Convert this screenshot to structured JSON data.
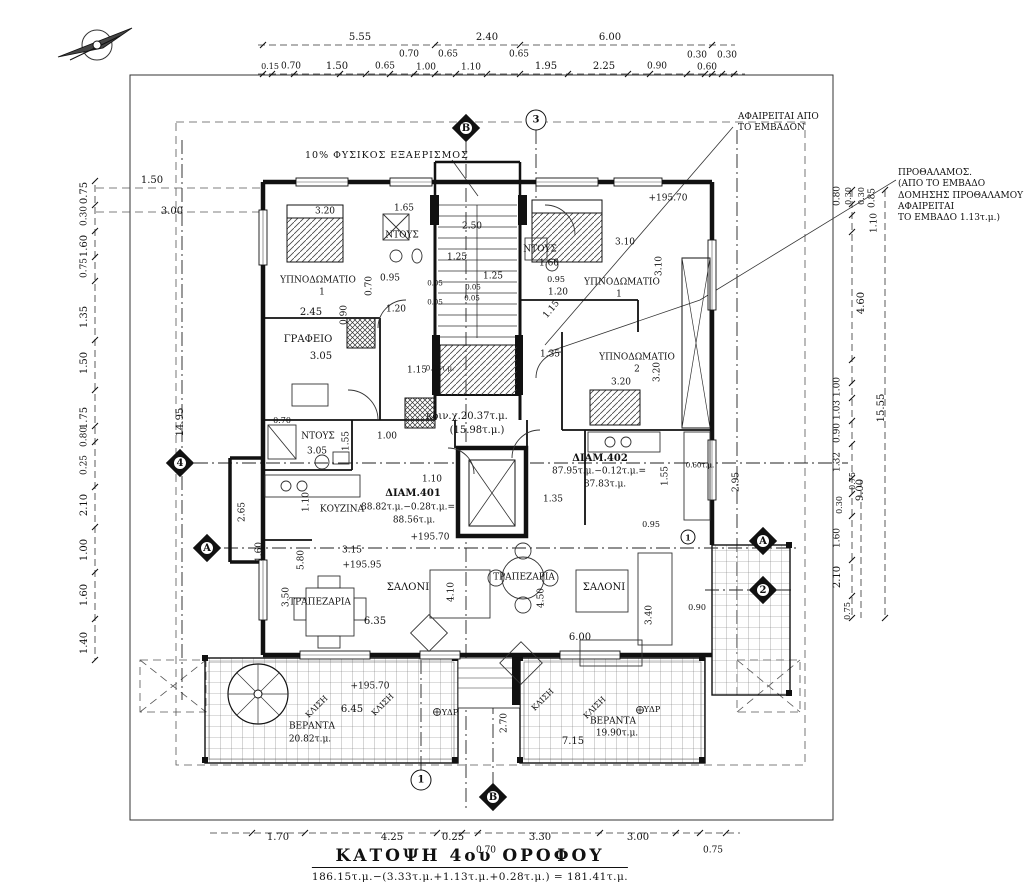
{
  "drawing": {
    "title": "ΚΑΤΟΨΗ 4ου ΟΡΟΦΟΥ",
    "area_formula": "186.15τ.μ.−(3.33τ.μ.+1.13τ.μ.+0.28τ.μ.) = 181.41τ.μ."
  },
  "notes": {
    "ventilation": "10% ΦΥΣΙΚΟΣ ΕΞΑΕΡΙΣΜΟΣ",
    "area_deduction": "ΑΦΑΙΡΕΙΤΑΙ ΑΠΟ\nΤΟ ΕΜΒΑΔΟΝ",
    "vestibule": "ΠΡΟΘΑΛΑΜΟΣ.\n(ΑΠΟ ΤΟ ΕΜΒΑΔΟ\nΔΟΜΗΣΗΣ ΠΡΟΘΑΛΑΜΟΥ\nΑΦΑΙΡΕΙΤΑΙ\nΤΟ ΕΜΒΑΔΟ 1.13τ.μ.)"
  },
  "colors": {
    "line": "#111111",
    "background": "#ffffff",
    "hatch": "#444444",
    "tile": "#777777"
  },
  "annotations": [
    {
      "t": "5.55",
      "x": 360,
      "y": 38
    },
    {
      "t": "2.40",
      "x": 487,
      "y": 38
    },
    {
      "t": "6.00",
      "x": 610,
      "y": 38
    },
    {
      "t": "0.15",
      "x": 270,
      "y": 67,
      "s": 8
    },
    {
      "t": "0.70",
      "x": 291,
      "y": 67,
      "s": 9
    },
    {
      "t": "1.50",
      "x": 337,
      "y": 67
    },
    {
      "t": "0.65",
      "x": 385,
      "y": 67,
      "s": 9
    },
    {
      "t": "0.70",
      "x": 409,
      "y": 55,
      "s": 9
    },
    {
      "t": "1.00",
      "x": 426,
      "y": 68,
      "s": 9
    },
    {
      "t": "0.65",
      "x": 448,
      "y": 55,
      "s": 9
    },
    {
      "t": "1.10",
      "x": 471,
      "y": 68,
      "s": 9
    },
    {
      "t": "0.65",
      "x": 519,
      "y": 55,
      "s": 9
    },
    {
      "t": "1.95",
      "x": 546,
      "y": 67
    },
    {
      "t": "2.25",
      "x": 604,
      "y": 67
    },
    {
      "t": "0.90",
      "x": 657,
      "y": 67,
      "s": 9
    },
    {
      "t": "0.30",
      "x": 697,
      "y": 56,
      "s": 9
    },
    {
      "t": "0.60",
      "x": 707,
      "y": 68,
      "s": 9
    },
    {
      "t": "0.30",
      "x": 727,
      "y": 56,
      "s": 9
    },
    {
      "t": "0.75",
      "x": 85,
      "y": 193,
      "r": -90
    },
    {
      "t": "0.30",
      "x": 85,
      "y": 216,
      "r": -90,
      "s": 9
    },
    {
      "t": "1.60",
      "x": 85,
      "y": 246,
      "r": -90
    },
    {
      "t": "0.75",
      "x": 85,
      "y": 268,
      "r": -90,
      "s": 9
    },
    {
      "t": "1.35",
      "x": 85,
      "y": 317,
      "r": -90
    },
    {
      "t": "1.50",
      "x": 85,
      "y": 363,
      "r": -90
    },
    {
      "t": "1.75",
      "x": 85,
      "y": 418,
      "r": -90
    },
    {
      "t": "0.80",
      "x": 85,
      "y": 437,
      "r": -90,
      "s": 9
    },
    {
      "t": "0.25",
      "x": 85,
      "y": 465,
      "r": -90,
      "s": 9
    },
    {
      "t": "2.10",
      "x": 85,
      "y": 505,
      "r": -90
    },
    {
      "t": "1.00",
      "x": 85,
      "y": 550,
      "r": -90
    },
    {
      "t": "1.60",
      "x": 85,
      "y": 595,
      "r": -90
    },
    {
      "t": "1.40",
      "x": 85,
      "y": 643,
      "r": -90
    },
    {
      "t": "14.95",
      "x": 181,
      "y": 422,
      "r": -90
    },
    {
      "t": "1.50",
      "x": 152,
      "y": 181
    },
    {
      "t": "3.00",
      "x": 172,
      "y": 212
    },
    {
      "t": "0.80",
      "x": 838,
      "y": 196,
      "r": -90,
      "s": 9
    },
    {
      "t": "0.30",
      "x": 849,
      "y": 196,
      "r": -90,
      "s": 8
    },
    {
      "t": "0.30",
      "x": 862,
      "y": 196,
      "r": -90,
      "s": 8
    },
    {
      "t": "0.85",
      "x": 873,
      "y": 198,
      "r": -90,
      "s": 9
    },
    {
      "t": "1.10",
      "x": 875,
      "y": 223,
      "r": -90,
      "s": 9
    },
    {
      "t": "4.60",
      "x": 862,
      "y": 303,
      "r": -90
    },
    {
      "t": "1.00",
      "x": 838,
      "y": 387,
      "r": -90,
      "s": 9
    },
    {
      "t": "1.03",
      "x": 838,
      "y": 410,
      "r": -90,
      "s": 9
    },
    {
      "t": "0.90",
      "x": 838,
      "y": 433,
      "r": -90,
      "s": 9
    },
    {
      "t": "1.32",
      "x": 838,
      "y": 462,
      "r": -90,
      "s": 9
    },
    {
      "t": "0.75",
      "x": 853,
      "y": 481,
      "r": -90,
      "s": 8
    },
    {
      "t": "9.00",
      "x": 861,
      "y": 490,
      "r": -90
    },
    {
      "t": "0.30",
      "x": 840,
      "y": 505,
      "r": -90,
      "s": 8
    },
    {
      "t": "1.60",
      "x": 838,
      "y": 538,
      "r": -90,
      "s": 9
    },
    {
      "t": "2.10",
      "x": 838,
      "y": 577,
      "r": -90
    },
    {
      "t": "0.75",
      "x": 848,
      "y": 611,
      "r": -90,
      "s": 8
    },
    {
      "t": "15.55",
      "x": 882,
      "y": 408,
      "r": -90
    },
    {
      "t": "1.70",
      "x": 278,
      "y": 838
    },
    {
      "t": "4.25",
      "x": 392,
      "y": 838
    },
    {
      "t": "0.25",
      "x": 453,
      "y": 838
    },
    {
      "t": "3.30",
      "x": 540,
      "y": 838
    },
    {
      "t": "3.00",
      "x": 638,
      "y": 838
    },
    {
      "t": "0.70",
      "x": 486,
      "y": 851,
      "s": 9
    },
    {
      "t": "0.75",
      "x": 713,
      "y": 851,
      "s": 9
    },
    {
      "t": "3.20",
      "x": 325,
      "y": 212,
      "s": 9
    },
    {
      "t": "1.65",
      "x": 404,
      "y": 209,
      "s": 9
    },
    {
      "t": "ΝΤΟΥΣ",
      "x": 402,
      "y": 236,
      "s": 9,
      "n": "room-label"
    },
    {
      "t": "2.50",
      "x": 472,
      "y": 227,
      "s": 9
    },
    {
      "t": "1.25",
      "x": 457,
      "y": 258,
      "s": 9
    },
    {
      "t": "1.25",
      "x": 493,
      "y": 277,
      "s": 9
    },
    {
      "t": "0.05",
      "x": 435,
      "y": 284,
      "s": 7
    },
    {
      "t": "0.05",
      "x": 473,
      "y": 288,
      "s": 7
    },
    {
      "t": "0.05",
      "x": 472,
      "y": 299,
      "s": 7
    },
    {
      "t": "0.05",
      "x": 435,
      "y": 303,
      "s": 7
    },
    {
      "t": "ΝΤΟΥΣ",
      "x": 540,
      "y": 250,
      "s": 9,
      "n": "room-label"
    },
    {
      "t": "1.60",
      "x": 549,
      "y": 264,
      "s": 9
    },
    {
      "t": "0.95",
      "x": 556,
      "y": 280,
      "s": 8
    },
    {
      "t": "1.20",
      "x": 558,
      "y": 293,
      "s": 9
    },
    {
      "t": "1.15",
      "x": 552,
      "y": 310,
      "r": -50,
      "s": 9
    },
    {
      "t": "0.95",
      "x": 390,
      "y": 279,
      "s": 9
    },
    {
      "t": "0.70",
      "x": 370,
      "y": 286,
      "r": -90,
      "s": 9
    },
    {
      "t": "0.90",
      "x": 345,
      "y": 315,
      "r": -90,
      "s": 9
    },
    {
      "t": "2.45",
      "x": 311,
      "y": 313
    },
    {
      "t": "1.20",
      "x": 396,
      "y": 310,
      "s": 9
    },
    {
      "t": "ΥΠΝΟΔΩΜΑΤΙΟ",
      "x": 318,
      "y": 281,
      "s": 9,
      "n": "room-label"
    },
    {
      "t": "1",
      "x": 322,
      "y": 293,
      "s": 9,
      "n": "room-label"
    },
    {
      "t": "ΥΠΝΟΔΩΜΑΤΙΟ",
      "x": 622,
      "y": 283,
      "s": 9,
      "n": "room-label"
    },
    {
      "t": "1",
      "x": 619,
      "y": 295,
      "s": 9,
      "n": "room-label"
    },
    {
      "t": "3.10",
      "x": 625,
      "y": 243,
      "s": 9
    },
    {
      "t": "3.10",
      "x": 660,
      "y": 266,
      "r": -90,
      "s": 9
    },
    {
      "t": "ΓΡΑΦΕΙΟ",
      "x": 308,
      "y": 340,
      "n": "room-label"
    },
    {
      "t": "3.05",
      "x": 321,
      "y": 357
    },
    {
      "t": "1.15",
      "x": 417,
      "y": 371,
      "s": 9
    },
    {
      "t": "0.28τ.μ.",
      "x": 440,
      "y": 369,
      "s": 7
    },
    {
      "t": "ΥΠΝΟΔΩΜΑΤΙΟ",
      "x": 637,
      "y": 358,
      "s": 9,
      "n": "room-label"
    },
    {
      "t": "2",
      "x": 637,
      "y": 370,
      "s": 9,
      "n": "room-label"
    },
    {
      "t": "3.20",
      "x": 621,
      "y": 383,
      "s": 9
    },
    {
      "t": "3.20",
      "x": 658,
      "y": 372,
      "r": -90,
      "s": 9
    },
    {
      "t": "1.35",
      "x": 550,
      "y": 355,
      "s": 9
    },
    {
      "t": "+195.70",
      "x": 668,
      "y": 199,
      "s": 9,
      "n": "level-label"
    },
    {
      "t": "κοιν.χ.20.37τ.μ.",
      "x": 467,
      "y": 417,
      "n": "area-label"
    },
    {
      "t": "(15.98τ.μ.)",
      "x": 477,
      "y": 431,
      "n": "area-label"
    },
    {
      "t": "ΝΤΟΥΣ",
      "x": 318,
      "y": 437,
      "s": 9,
      "n": "room-label"
    },
    {
      "t": "3.05",
      "x": 317,
      "y": 452,
      "s": 9
    },
    {
      "t": "1.55",
      "x": 347,
      "y": 441,
      "r": -90,
      "s": 9
    },
    {
      "t": "1.00",
      "x": 387,
      "y": 437,
      "s": 9
    },
    {
      "t": "0.70",
      "x": 282,
      "y": 421,
      "s": 8
    },
    {
      "t": "1.10",
      "x": 307,
      "y": 502,
      "r": -90,
      "s": 9
    },
    {
      "t": "ΚΟΥΖΙΝΑ",
      "x": 342,
      "y": 510,
      "s": 9,
      "n": "room-label"
    },
    {
      "t": "ΔΙΑΜ.401",
      "x": 413,
      "y": 494,
      "b": true,
      "n": "apartment-label"
    },
    {
      "t": "88.82τ.μ.−0.28τ.μ.=",
      "x": 408,
      "y": 508,
      "s": 9,
      "n": "area-label"
    },
    {
      "t": "88.56τ.μ.",
      "x": 414,
      "y": 521,
      "s": 9,
      "n": "area-label"
    },
    {
      "t": "+195.70",
      "x": 430,
      "y": 538,
      "s": 9,
      "n": "level-label"
    },
    {
      "t": "1.10",
      "x": 432,
      "y": 480,
      "s": 9
    },
    {
      "t": "ΔΙΑΜ.402",
      "x": 600,
      "y": 459,
      "b": true,
      "n": "apartment-label"
    },
    {
      "t": "87.95τ.μ.−0.12τ.μ.=",
      "x": 599,
      "y": 472,
      "s": 9,
      "n": "area-label"
    },
    {
      "t": "87.83τ.μ.",
      "x": 605,
      "y": 485,
      "s": 9,
      "n": "area-label"
    },
    {
      "t": "1.55",
      "x": 666,
      "y": 476,
      "r": -90,
      "s": 9
    },
    {
      "t": "1.35",
      "x": 553,
      "y": 500,
      "s": 9
    },
    {
      "t": "2.95",
      "x": 737,
      "y": 482,
      "r": -90,
      "s": 9
    },
    {
      "t": "0.60τ.μ.",
      "x": 700,
      "y": 466,
      "s": 7
    },
    {
      "t": "0.95",
      "x": 651,
      "y": 525,
      "s": 8
    },
    {
      "t": "2.65",
      "x": 243,
      "y": 512,
      "r": -90,
      "s": 9
    },
    {
      "t": "3.15",
      "x": 352,
      "y": 551,
      "s": 9
    },
    {
      "t": "5.80",
      "x": 302,
      "y": 560,
      "r": -90,
      "s": 9
    },
    {
      "t": "+195.95",
      "x": 362,
      "y": 566,
      "s": 9,
      "n": "level-label"
    },
    {
      "t": "3.50",
      "x": 287,
      "y": 597,
      "r": -90,
      "s": 9
    },
    {
      "t": "ΤΡΑΠΕΖΑΡΙΑ",
      "x": 320,
      "y": 603,
      "s": 9,
      "n": "room-label"
    },
    {
      "t": "ΣΑΛΟΝΙ",
      "x": 408,
      "y": 588,
      "n": "room-label"
    },
    {
      "t": "6.35",
      "x": 375,
      "y": 622
    },
    {
      "t": "4.10",
      "x": 452,
      "y": 592,
      "r": -90,
      "s": 9
    },
    {
      "t": "1.60",
      "x": 260,
      "y": 552,
      "r": -90,
      "s": 9
    },
    {
      "t": "ΤΡΑΠΕΖΑΡΙΑ",
      "x": 524,
      "y": 578,
      "s": 9,
      "n": "room-label"
    },
    {
      "t": "ΣΑΛΟΝΙ",
      "x": 604,
      "y": 588,
      "n": "room-label"
    },
    {
      "t": "4.50",
      "x": 542,
      "y": 598,
      "r": -90,
      "s": 9
    },
    {
      "t": "3.40",
      "x": 650,
      "y": 615,
      "r": -90,
      "s": 9
    },
    {
      "t": "6.00",
      "x": 580,
      "y": 638
    },
    {
      "t": "0.90",
      "x": 697,
      "y": 608,
      "s": 8
    },
    {
      "t": "+195.70",
      "x": 370,
      "y": 687,
      "s": 9,
      "n": "level-label"
    },
    {
      "t": "6.45",
      "x": 352,
      "y": 710
    },
    {
      "t": "ΚΛΙΣΗ",
      "x": 317,
      "y": 707,
      "r": -45,
      "s": 8,
      "n": "slope-label"
    },
    {
      "t": "ΚΛΙΣΗ",
      "x": 383,
      "y": 705,
      "r": -45,
      "s": 8,
      "n": "slope-label"
    },
    {
      "t": "ΥΔΡ",
      "x": 450,
      "y": 713,
      "s": 8,
      "n": "drain-label"
    },
    {
      "t": "ΒΕΡΑΝΤΑ",
      "x": 312,
      "y": 727,
      "s": 9,
      "n": "room-label"
    },
    {
      "t": "20.82τ.μ.",
      "x": 310,
      "y": 740,
      "s": 9,
      "n": "area-label"
    },
    {
      "t": "2.70",
      "x": 505,
      "y": 723,
      "r": -90,
      "s": 9
    },
    {
      "t": "ΚΛΙΣΗ",
      "x": 543,
      "y": 700,
      "r": -45,
      "s": 8,
      "n": "slope-label"
    },
    {
      "t": "ΚΛΙΣΗ",
      "x": 595,
      "y": 708,
      "r": -45,
      "s": 8,
      "n": "slope-label"
    },
    {
      "t": "ΒΕΡΑΝΤΑ",
      "x": 613,
      "y": 722,
      "s": 9,
      "n": "room-label"
    },
    {
      "t": "19.90τ.μ.",
      "x": 617,
      "y": 734,
      "s": 9,
      "n": "area-label"
    },
    {
      "t": "ΥΔΡ",
      "x": 652,
      "y": 710,
      "s": 8,
      "n": "drain-label"
    },
    {
      "t": "7.15",
      "x": 573,
      "y": 742
    }
  ],
  "markers": [
    {
      "shape": "diamond",
      "label": "B",
      "x": 466,
      "y": 128
    },
    {
      "shape": "circle",
      "label": "3",
      "x": 536,
      "y": 120
    },
    {
      "shape": "diamond",
      "label": "4",
      "x": 180,
      "y": 463
    },
    {
      "shape": "diamond",
      "label": "A",
      "x": 207,
      "y": 548
    },
    {
      "shape": "diamond",
      "label": "A",
      "x": 763,
      "y": 541
    },
    {
      "shape": "diamond",
      "label": "2",
      "x": 763,
      "y": 590
    },
    {
      "shape": "circle",
      "label": "1",
      "x": 421,
      "y": 780
    },
    {
      "shape": "diamond",
      "label": "B",
      "x": 493,
      "y": 797
    },
    {
      "shape": "circle",
      "label": "1",
      "x": 688,
      "y": 537,
      "sm": true
    }
  ]
}
